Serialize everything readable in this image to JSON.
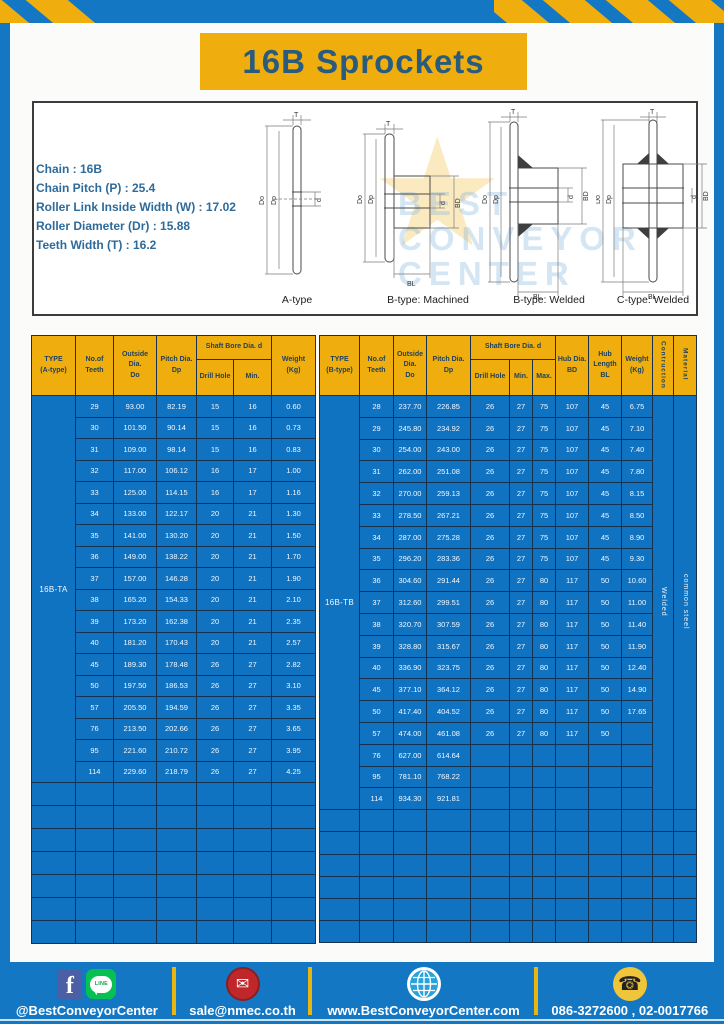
{
  "page": {
    "title": "16B Sprockets"
  },
  "specs": {
    "lines": [
      "Chain  :  16B",
      "Chain Pitch (P)  :  25.4",
      "Roller Link Inside Width (W)  :  17.02",
      "Roller Diameter (Dr)  : 15.88",
      "Teeth Width (T)  :  16.2"
    ]
  },
  "diagrams": {
    "captions": [
      "A-type",
      "B-type: Machined",
      "B-type: Welded",
      "C-type: Welded"
    ],
    "dims": {
      "T": "T",
      "Do": "Do",
      "Dp": "Dp",
      "d": "d",
      "BD": "BD",
      "BL": "BL"
    }
  },
  "watermark": {
    "lines": [
      "BEST",
      "CONVEYOR",
      "CENTER"
    ]
  },
  "tables": {
    "left": {
      "headers": {
        "type": "TYPE\n(A-type)",
        "teeth": "No.of\nTeeth",
        "outside": "Outside\nDia.\nDo",
        "pitch": "Pitch Dia.\nDp",
        "shaft_group": "Shaft Bore Dia. d",
        "drill": "Drill Hole",
        "min": "Min.",
        "weight": "Weight\n(Kg)"
      },
      "type_value": "16B-TA",
      "rows": [
        [
          "29",
          "93.00",
          "82.19",
          "15",
          "16",
          "0.60"
        ],
        [
          "30",
          "101.50",
          "90.14",
          "15",
          "16",
          "0.73"
        ],
        [
          "31",
          "109.00",
          "98.14",
          "15",
          "16",
          "0.83"
        ],
        [
          "32",
          "117.00",
          "106.12",
          "16",
          "17",
          "1.00"
        ],
        [
          "33",
          "125.00",
          "114.15",
          "16",
          "17",
          "1.16"
        ],
        [
          "34",
          "133.00",
          "122.17",
          "20",
          "21",
          "1.30"
        ],
        [
          "35",
          "141.00",
          "130.20",
          "20",
          "21",
          "1.50"
        ],
        [
          "36",
          "149.00",
          "138.22",
          "20",
          "21",
          "1.70"
        ],
        [
          "37",
          "157.00",
          "146.28",
          "20",
          "21",
          "1.90"
        ],
        [
          "38",
          "165.20",
          "154.33",
          "20",
          "21",
          "2.10"
        ],
        [
          "39",
          "173.20",
          "162.38",
          "20",
          "21",
          "2.35"
        ],
        [
          "40",
          "181.20",
          "170.43",
          "20",
          "21",
          "2.57"
        ],
        [
          "45",
          "189.30",
          "178.48",
          "26",
          "27",
          "2.82"
        ],
        [
          "50",
          "197.50",
          "186.53",
          "26",
          "27",
          "3.10"
        ],
        [
          "57",
          "205.50",
          "194.59",
          "26",
          "27",
          "3.35"
        ],
        [
          "76",
          "213.50",
          "202.66",
          "26",
          "27",
          "3.65"
        ],
        [
          "95",
          "221.60",
          "210.72",
          "26",
          "27",
          "3.95"
        ],
        [
          "114",
          "229.60",
          "218.79",
          "26",
          "27",
          "4.25"
        ]
      ],
      "empty_rows": 7
    },
    "right": {
      "headers": {
        "type": "TYPE\n(B-type)",
        "teeth": "No.of\nTeeth",
        "outside": "Outside\nDia.\nDo",
        "pitch": "Pitch Dia.\nDp",
        "shaft_group": "Shaft Bore Dia. d",
        "drill": "Drill Hole",
        "min": "Min.",
        "max": "Max.",
        "hub_dia": "Hub Dia.\nBD",
        "hub_len": "Hub\nLength\nBL",
        "weight": "Weight\n(Kg)",
        "construction": "Contruction",
        "material": "Material"
      },
      "type_value": "16B-TB",
      "construction_value": "Welded",
      "material_value": "common steel",
      "rows": [
        [
          "28",
          "237.70",
          "226.85",
          "26",
          "27",
          "75",
          "107",
          "45",
          "6.75"
        ],
        [
          "29",
          "245.80",
          "234.92",
          "26",
          "27",
          "75",
          "107",
          "45",
          "7.10"
        ],
        [
          "30",
          "254.00",
          "243.00",
          "26",
          "27",
          "75",
          "107",
          "45",
          "7.40"
        ],
        [
          "31",
          "262.00",
          "251.08",
          "26",
          "27",
          "75",
          "107",
          "45",
          "7.80"
        ],
        [
          "32",
          "270.00",
          "259.13",
          "26",
          "27",
          "75",
          "107",
          "45",
          "8.15"
        ],
        [
          "33",
          "278.50",
          "267.21",
          "26",
          "27",
          "75",
          "107",
          "45",
          "8.50"
        ],
        [
          "34",
          "287.00",
          "275.28",
          "26",
          "27",
          "75",
          "107",
          "45",
          "8.90"
        ],
        [
          "35",
          "296.20",
          "283.36",
          "26",
          "27",
          "75",
          "107",
          "45",
          "9.30"
        ],
        [
          "36",
          "304.60",
          "291.44",
          "26",
          "27",
          "80",
          "117",
          "50",
          "10.60"
        ],
        [
          "37",
          "312.60",
          "299.51",
          "26",
          "27",
          "80",
          "117",
          "50",
          "11.00"
        ],
        [
          "38",
          "320.70",
          "307.59",
          "26",
          "27",
          "80",
          "117",
          "50",
          "11.40"
        ],
        [
          "39",
          "328.80",
          "315.67",
          "26",
          "27",
          "80",
          "117",
          "50",
          "11.90"
        ],
        [
          "40",
          "336.90",
          "323.75",
          "26",
          "27",
          "80",
          "117",
          "50",
          "12.40"
        ],
        [
          "45",
          "377.10",
          "364.12",
          "26",
          "27",
          "80",
          "117",
          "50",
          "14.90"
        ],
        [
          "50",
          "417.40",
          "404.52",
          "26",
          "27",
          "80",
          "117",
          "50",
          "17.65"
        ],
        [
          "57",
          "474.00",
          "461.08",
          "26",
          "27",
          "80",
          "117",
          "50",
          ""
        ],
        [
          "76",
          "627.00",
          "614.64",
          "",
          "",
          "",
          "",
          "",
          ""
        ],
        [
          "95",
          "781.10",
          "768.22",
          "",
          "",
          "",
          "",
          "",
          ""
        ],
        [
          "114",
          "934.30",
          "921.81",
          "",
          "",
          "",
          "",
          "",
          ""
        ]
      ],
      "empty_rows": 6
    }
  },
  "footer": {
    "sections": [
      {
        "label": "@BestConveyorCenter"
      },
      {
        "label": "sale@nmec.co.th"
      },
      {
        "label": "www.BestConveyorCenter.com"
      },
      {
        "label": "086-3272600 , 02-0017766"
      }
    ]
  }
}
